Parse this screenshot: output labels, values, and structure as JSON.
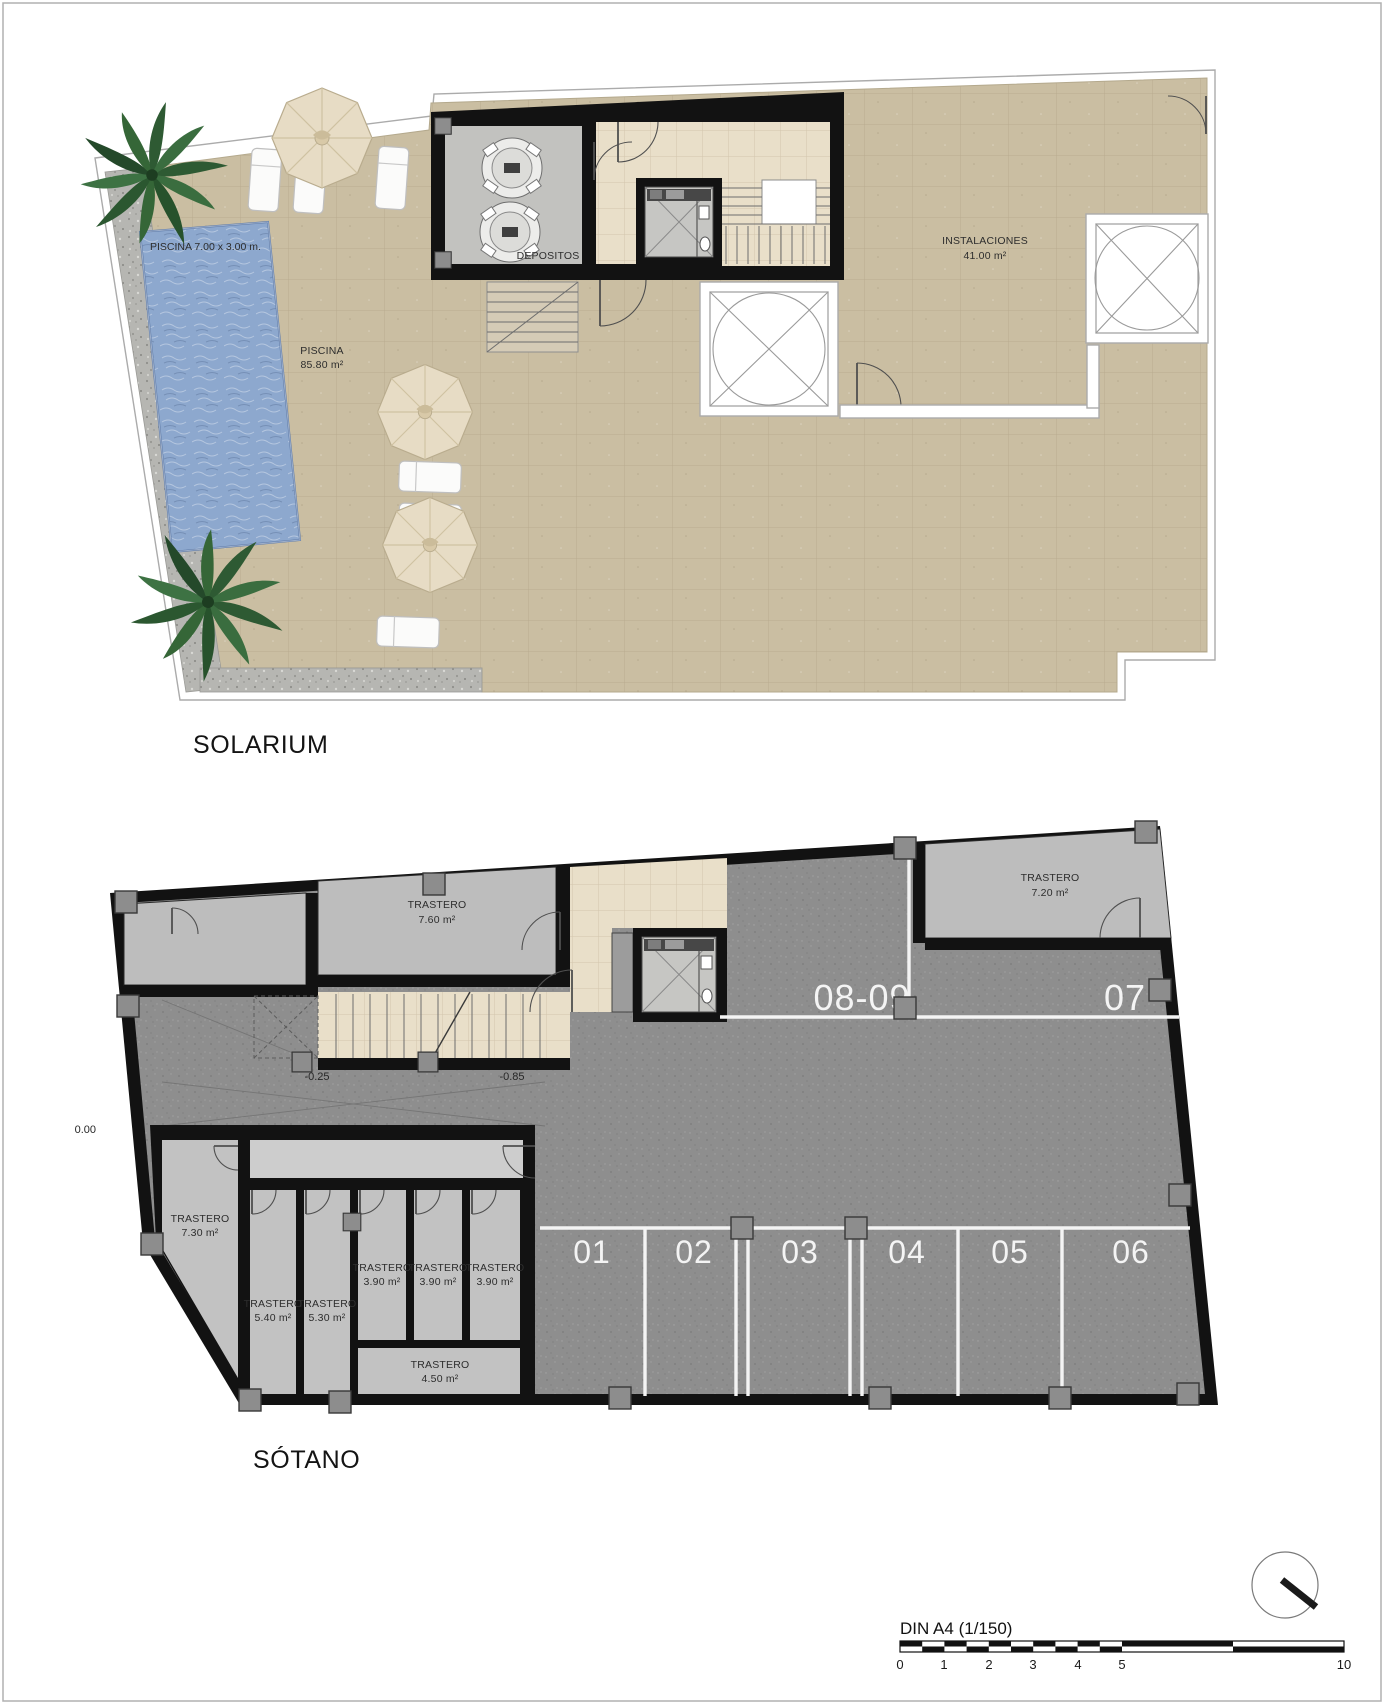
{
  "solarium": {
    "title": "SOLARIUM",
    "pool": {
      "dim_label": "PISCINA 7.00 x 3.00 m.",
      "name": "PISCINA",
      "area": "85.80 m²"
    },
    "depositos_label": "DEPOSITOS",
    "instalaciones": {
      "name": "INSTALACIONES",
      "area": "41.00 m²"
    }
  },
  "sotano": {
    "title": "SÓTANO",
    "levels": {
      "zero": "0.00",
      "mid": "-0.25",
      "low": "-0.85",
      "slope": "5%"
    },
    "parking_top": [
      "08-09",
      "07"
    ],
    "parking_spots": [
      "01",
      "02",
      "03",
      "04",
      "05",
      "06"
    ],
    "trasteros": [
      {
        "name": "TRASTERO",
        "area": "7.60 m²"
      },
      {
        "name": "TRASTERO",
        "area": "7.20 m²"
      },
      {
        "name": "TRASTERO",
        "area": "7.30 m²"
      },
      {
        "name": "TRASTERO",
        "area": "5.40 m²"
      },
      {
        "name": "TRASTERO",
        "area": "5.30 m²"
      },
      {
        "name": "TRASTERO",
        "area": "3.90 m²"
      },
      {
        "name": "TRASTERO",
        "area": "3.90 m²"
      },
      {
        "name": "TRASTERO",
        "area": "3.90 m²"
      },
      {
        "name": "TRASTERO",
        "area": "4.50 m²"
      }
    ]
  },
  "scalebar": {
    "label": "DIN A4 (1/150)",
    "ticks": [
      "0",
      "1",
      "2",
      "3",
      "4",
      "5",
      "10"
    ]
  },
  "colors": {
    "terrace": "#cabea2",
    "lobby_tile": "#e9dfc9",
    "pool_water": "#8da8ce",
    "asphalt": "#8e8e8e",
    "storage": "#bdbdbd",
    "corridor": "#cdcdcd",
    "wall": "#121212",
    "gravel": "#b6b6b2",
    "stall_line": "#f4f4f4"
  }
}
